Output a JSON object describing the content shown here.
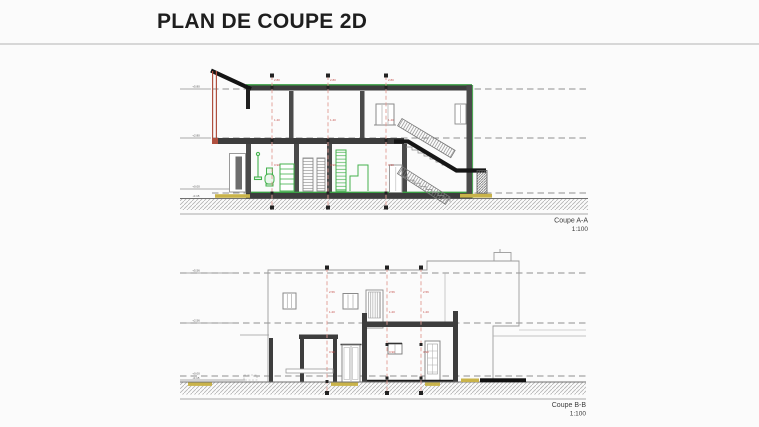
{
  "page": {
    "title": "PLAN DE COUPE 2D"
  },
  "colors": {
    "wall_dark": "#3d3d3d",
    "axis_red": "#e09b93",
    "accent_green": "#3a9e44",
    "fixture_green": "#44b24e",
    "ground_tan": "#c9b34a",
    "section_red_wall": "#b0503f"
  },
  "sections": {
    "a": {
      "label": "Coupe A-A",
      "scale": "1:100",
      "levels": [
        "+5.80",
        "+2.80",
        "+0.00",
        "-0.15"
      ],
      "axis_dims": [
        "2.80",
        "1.40",
        "0.90"
      ]
    },
    "b": {
      "label": "Coupe B-B",
      "scale": "1:100",
      "levels": [
        "+5.56",
        "+2.56",
        "+0.00",
        "-0.15"
      ],
      "axis_dims": [
        "2.56",
        "1.20",
        "0.90"
      ]
    }
  }
}
